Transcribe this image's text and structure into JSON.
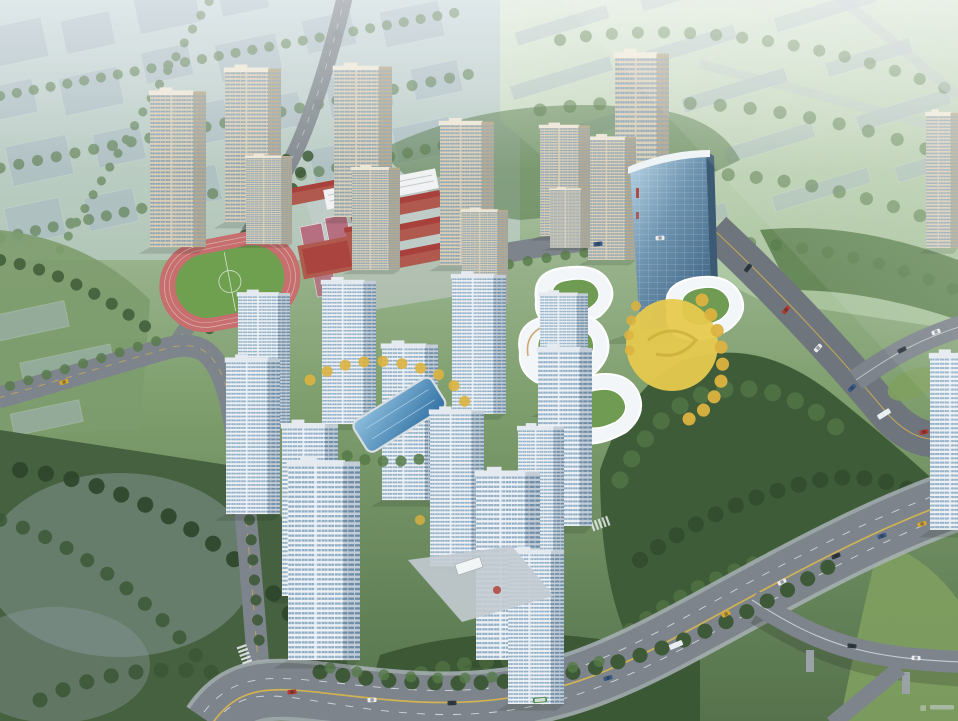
{
  "scene": {
    "kind_label": "aerial-masterplan-rendering"
  },
  "watermark": {
    "glyph": "▦"
  },
  "colors": {
    "haze": "#c9d7dd",
    "ghost": "#a9b9c4",
    "ghostEdge": "#e2ebef",
    "fieldLight": "#d8e5d2",
    "field": "#b7cdad",
    "green": "#7d9c6e",
    "parkDark": "#46613f",
    "tree": "#3a5634",
    "treeLight": "#567a48",
    "treeDark": "#2c452a",
    "forest": "#3f5c39",
    "gold": "#dcb23f",
    "road": "#7d848b",
    "roadDark": "#6e757c",
    "sidewalk": "#a9b1b7",
    "laneYellow": "#d9b84e",
    "laneWhite": "#eef1f3",
    "creamFace": "#dacfb6",
    "creamSide": "#b5a98e",
    "creamRoof": "#ece6d6",
    "creamWin": "#8aa2b4",
    "whiteFace": "#eef2f6",
    "whiteSide": "#c2cdd7",
    "whiteRoof": "#e4eaf0",
    "whiteWin": "#8fadc4",
    "whiteWinDark": "#6e8ca6",
    "glassLight": "#b7d3e4",
    "glassDark": "#3f6484",
    "commWhite": "#f3f6f8",
    "commShade": "#d9e1e7",
    "greenRoof": "#6f9b52",
    "terrace": "#c79e63",
    "plazaYellow": "#e6c94e",
    "pool": "#2f6fa3",
    "poolLight": "#8fc0de",
    "trackPink": "#c76f6e",
    "trackGreen": "#6fa050",
    "court": "#b56f80",
    "redRoof": "#a8413c",
    "brick": "#b05a4f",
    "schoolWhite": "#f0f2f3",
    "shadow": "#1c2a1c",
    "watermark": "#ccd4d9",
    "carWhite": "#e8ecef",
    "carDark": "#2e3840",
    "carRed": "#b03a30",
    "carBlue": "#3a5a86",
    "carYellow": "#d9a92f",
    "busGreen": "#4e8a4e"
  }
}
